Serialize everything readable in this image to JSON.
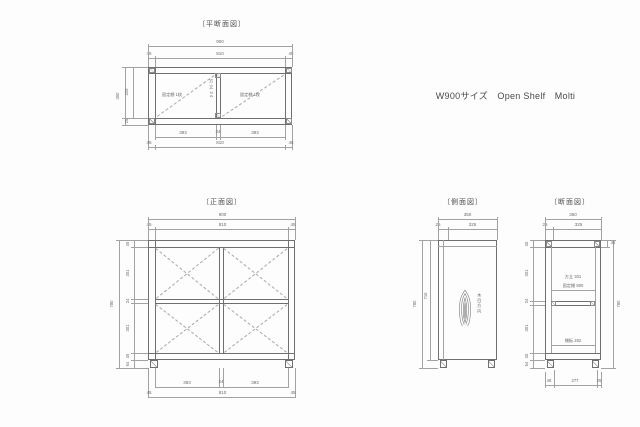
{
  "colors": {
    "background": "#fdfdfd",
    "outline": "#6f6f6f",
    "dim_line": "#a2a2a2",
    "text": "#5c5c5c"
  },
  "header": {
    "product_label": "W900サイズ　Open Shelf　Molti"
  },
  "plan": {
    "title": "〔平断面図〕",
    "dims": {
      "width_total": "900",
      "width_inner": "810",
      "side": "45",
      "depth_total": "350",
      "depth_inner": "325",
      "front_edge": "25",
      "bay": "393",
      "divider": "24",
      "bottom_inner": "810"
    },
    "labels": {
      "left_bay": "固定棚 1枚",
      "right_bay": "固定棚 1枚",
      "divider": "方立 24"
    }
  },
  "front": {
    "title": "〔正面図〕",
    "dims": {
      "width_total": "900",
      "width_inner": "810",
      "side": "45",
      "height_total": "780",
      "panel": "45",
      "opening": "301",
      "shelf": "24",
      "base": "45",
      "leg": "64",
      "bay": "393",
      "divider": "24",
      "bottom_inner": "810"
    }
  },
  "side": {
    "title": "〔側面図〕",
    "dims": {
      "depth_total": "350",
      "front_edge": "25",
      "depth_inner": "325",
      "height_total": "780",
      "body_height": "716"
    },
    "labels": {
      "grain": "木目方向"
    }
  },
  "section": {
    "title": "〔断面図〕",
    "dims": {
      "depth_total": "350",
      "front_edge": "25",
      "depth_inner": "325",
      "height_total": "780",
      "top_panel": "45",
      "opening": "301",
      "shelf": "24",
      "base": "45",
      "leg": "64",
      "top_right": "45",
      "bottom_left": "48",
      "bottom_mid": "277",
      "bottom_right": "25"
    },
    "labels": {
      "divider": "方立 301",
      "fixed_shelf": "固定棚 800",
      "shelf_board": "棚板 262"
    }
  }
}
